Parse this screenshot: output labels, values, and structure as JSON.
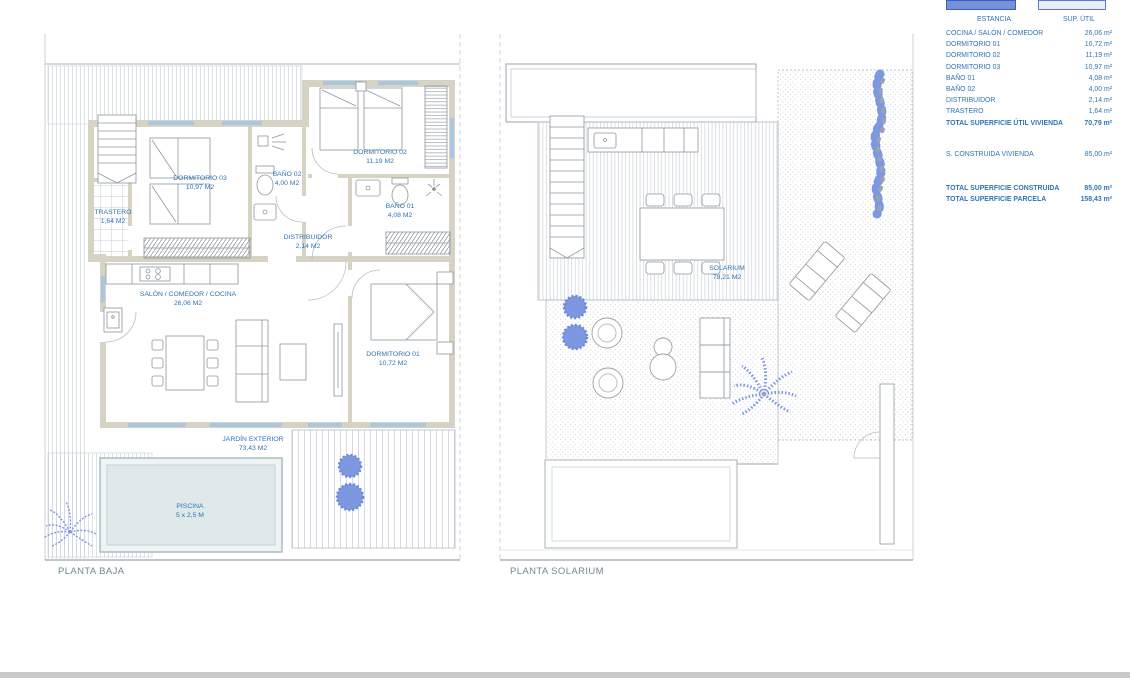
{
  "area_table": {
    "col_estancia": "ESTANCIA",
    "col_sup": "SUP. ÚTIL",
    "rows": [
      {
        "name": "COCINA / SALÓN / COMEDOR",
        "value": "26,06 m²"
      },
      {
        "name": "DORMITORIO 01",
        "value": "10,72 m²"
      },
      {
        "name": "DORMITORIO 02",
        "value": "11,19 m²"
      },
      {
        "name": "DORMITORIO 03",
        "value": "10,97 m²"
      },
      {
        "name": "BAÑO 01",
        "value": "4,08 m²"
      },
      {
        "name": "BAÑO 02",
        "value": "4,00 m²"
      },
      {
        "name": "DISTRIBUIDOR",
        "value": "2,14 m²"
      },
      {
        "name": "TRASTERO",
        "value": "1,64 m²"
      }
    ],
    "total_util": {
      "name": "TOTAL SUPERFICIE ÚTIL VIVIENDA",
      "value": "70,79 m²"
    },
    "construida": {
      "name": "S. CONSTRUIDA VIVIENDA",
      "value": "85,00 m²"
    },
    "total_construida": {
      "name": "TOTAL SUPERFICIE CONSTRUIDA",
      "value": "85,00 m²"
    },
    "total_parcela": {
      "name": "TOTAL SUPERFICIE PARCELA",
      "value": "158,43 m²"
    }
  },
  "floor_plans": {
    "left": {
      "title": "PLANTA BAJA",
      "rooms": {
        "trastero": {
          "name": "TRASTERO",
          "area": "1,64 M2"
        },
        "dormitorio03": {
          "name": "DORMITORIO 03",
          "area": "10,97 M2"
        },
        "bano02": {
          "name": "BAÑO 02",
          "area": "4,00 M2"
        },
        "dormitorio02": {
          "name": "DORMITORIO 02",
          "area": "11,19 M2"
        },
        "bano01": {
          "name": "BAÑO 01",
          "area": "4,08 M2"
        },
        "distribuidor": {
          "name": "DISTRIBUIDOR",
          "area": "2,14 M2"
        },
        "salon": {
          "name": "SALÓN / COMEDOR / COCINA",
          "area": "26,06 M2"
        },
        "dormitorio01": {
          "name": "DORMITORIO 01",
          "area": "10,72 M2"
        },
        "jardin": {
          "name": "JARDÍN EXTERIOR",
          "area": "73,43 M2"
        },
        "piscina": {
          "name": "PISCINA",
          "area": "5 x 2,5 M"
        }
      }
    },
    "right": {
      "title": "PLANTA SOLARIUM",
      "rooms": {
        "solarium": {
          "name": "SOLARIUM",
          "area": "78,21 M2"
        }
      }
    }
  },
  "colors": {
    "accent_text": "#2E74B5",
    "plan_title": "#6D8A94",
    "wall": "#D6D2C4",
    "plant_blue": "#7D97E0",
    "pool_fill": "#DFE9E9",
    "header_box_solid": "#7591D8",
    "header_box_light": "#E7EDF9",
    "header_box_border": "#3D5DC3"
  }
}
